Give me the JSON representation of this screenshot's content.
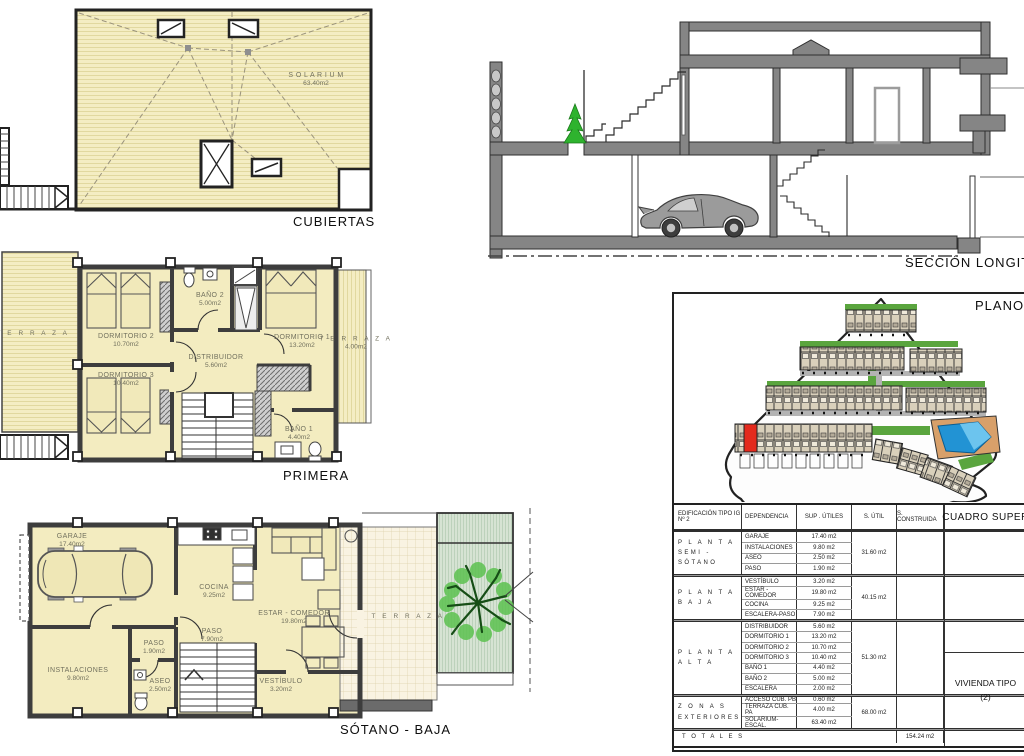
{
  "cubiertas": {
    "title": "CUBIERTAS",
    "room": {
      "name": "S O L A R I U M",
      "area": "63.40m2"
    }
  },
  "seccion": {
    "title": "SECCIÓN  LONGITU"
  },
  "primera": {
    "title": "PRIMERA",
    "rooms": {
      "terraza_izq": {
        "name": "T E R R A Z A",
        "area": ""
      },
      "dormitorio2": {
        "name": "DORMITORIO 2",
        "area": "10.70m2"
      },
      "dormitorio3": {
        "name": "DORMITORIO 3",
        "area": "10.40m2"
      },
      "bano2": {
        "name": "BAÑO 2",
        "area": "5.00m2"
      },
      "distribuidor": {
        "name": "DISTRIBUIDOR",
        "area": "5.60m2"
      },
      "dormitorio1": {
        "name": "DORMITORIO 1",
        "area": "13.20m2"
      },
      "terraza_der": {
        "name": "T E R R A Z A",
        "area": "4.00m2"
      },
      "bano1": {
        "name": "BAÑO 1",
        "area": "4.40m2"
      }
    }
  },
  "sotano": {
    "title": "SÓTANO - BAJA",
    "rooms": {
      "garaje": {
        "name": "GARAJE",
        "area": "17.40m2"
      },
      "cocina": {
        "name": "COCINA",
        "area": "9.25m2"
      },
      "estar": {
        "name": "ESTAR - COMEDOR",
        "area": "19.80m2"
      },
      "paso1": {
        "name": "PASO",
        "area": "1.90m2"
      },
      "paso2": {
        "name": "PASO",
        "area": "7.90m2"
      },
      "instalaciones": {
        "name": "INSTALACIONES",
        "area": "9.80m2"
      },
      "aseo": {
        "name": "ASEO",
        "area": "2.50m2"
      },
      "vestibulo": {
        "name": "VESTÍBULO",
        "area": "3.20m2"
      },
      "terraza": {
        "name": "T E R R A Z A",
        "area": ""
      }
    }
  },
  "siteplan": {
    "title": "PLANO C",
    "highlight_color": "#e42a1d",
    "pool_color": "#2293d4",
    "green_color": "#5aa53e"
  },
  "table": {
    "header": {
      "c1a": "EDIFICACIÓN  TIPO IG",
      "c1b": "Nº 2",
      "c2": "DEPENDENCIA",
      "c3": "SUP . ÚTILES",
      "c4": "S. ÚTIL",
      "c5": "S. CONSTRUIDA",
      "c6": "CUADRO SUPER"
    },
    "groups": [
      {
        "label1": "P L A N T A",
        "label2": "SEMI - SÓTANO",
        "subtotal": "31.60 m2",
        "rows": [
          {
            "dep": "GARAJE",
            "sup": "17.40 m2"
          },
          {
            "dep": "INSTALACIONES",
            "sup": "9.80 m2"
          },
          {
            "dep": "ASEO",
            "sup": "2.50 m2"
          },
          {
            "dep": "PASO",
            "sup": "1.90 m2"
          }
        ]
      },
      {
        "label1": "P L A N T A",
        "label2": "B A J A",
        "subtotal": "40.15 m2",
        "rows": [
          {
            "dep": "VESTÍBULO",
            "sup": "3.20 m2"
          },
          {
            "dep": "ESTAR - COMEDOR",
            "sup": "19.80 m2"
          },
          {
            "dep": "COCINA",
            "sup": "9.25 m2"
          },
          {
            "dep": "ESCALERA-PASO",
            "sup": "7.90 m2"
          }
        ]
      },
      {
        "label1": "P L A N T A",
        "label2": "A L T A",
        "subtotal": "51.30 m2",
        "rows": [
          {
            "dep": "DISTRIBUIDOR",
            "sup": "5.60 m2"
          },
          {
            "dep": "DORMITORIO 1",
            "sup": "13.20 m2"
          },
          {
            "dep": "DORMITORIO 2",
            "sup": "10.70 m2"
          },
          {
            "dep": "DORMITORIO 3",
            "sup": "10.40 m2"
          },
          {
            "dep": "BAÑO 1",
            "sup": "4.40 m2"
          },
          {
            "dep": "BAÑO 2",
            "sup": "5.00 m2"
          },
          {
            "dep": "ESCALERA",
            "sup": "2.00 m2"
          }
        ]
      },
      {
        "label1": "Z O N A S",
        "label2": "EXTERIORES",
        "subtotal": "68.00 m2",
        "rows": [
          {
            "dep": "ACCESO CUB. PB",
            "sup": "0.60 m2"
          },
          {
            "dep": "TERRAZA CUB. PA",
            "sup": "4.00 m2"
          },
          {
            "dep": "SOLARIUM-ESCAL.",
            "sup": "63.40 m2"
          }
        ]
      },
      {
        "label1": "",
        "label2": "",
        "subtotal": "",
        "rows": []
      }
    ],
    "totals": {
      "label": "T O T A L E S",
      "built": "154.24 m2"
    },
    "vivienda": {
      "line1": "VIVIENDA TIPO",
      "line2": "(2)"
    }
  }
}
